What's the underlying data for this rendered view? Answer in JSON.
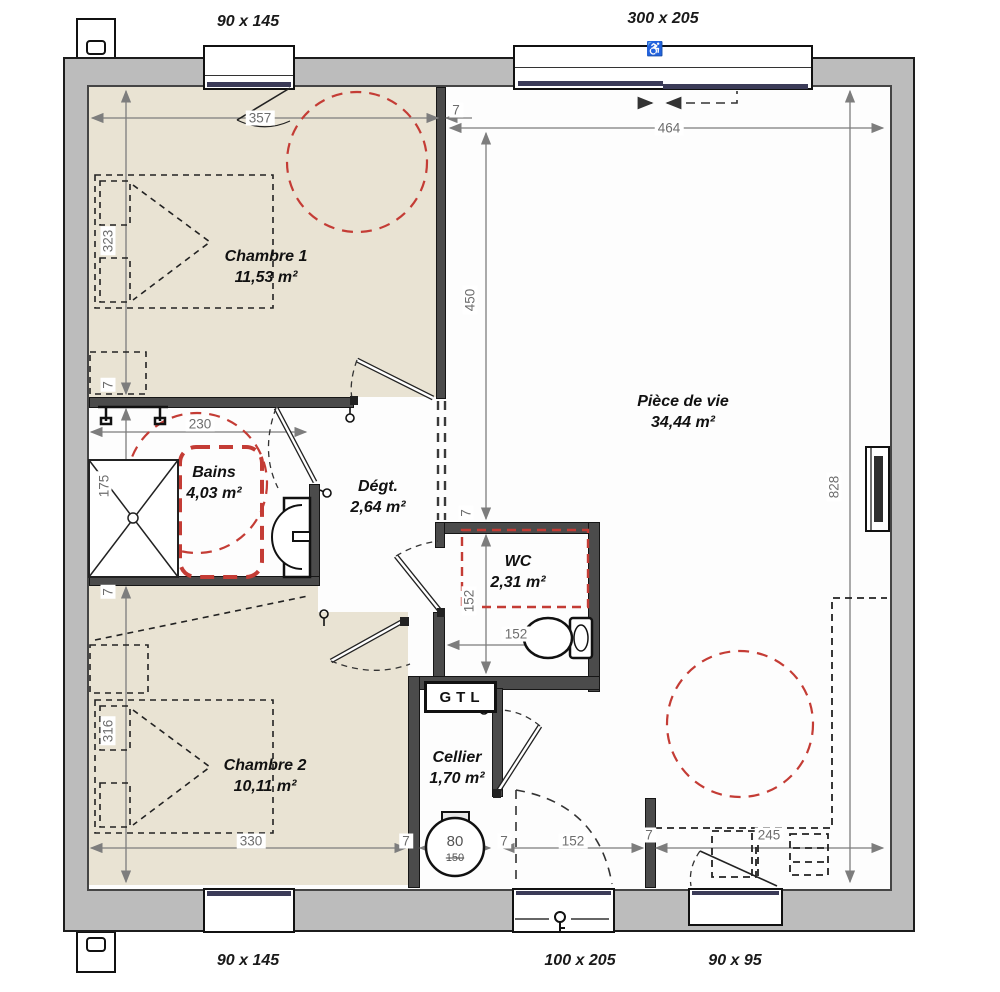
{
  "plan": {
    "openings": {
      "top_left_window": "90 x 145",
      "top_right_bay": "300 x 205",
      "bottom_left_window": "90 x 145",
      "entry_door": "100 x 205",
      "bottom_right_window": "90 x 95"
    },
    "rooms": {
      "chambre1": {
        "name": "Chambre 1",
        "area": "11,53 m²"
      },
      "piece_de_vie": {
        "name": "Pièce de vie",
        "area": "34,44 m²"
      },
      "bains": {
        "name": "Bains",
        "area": "4,03 m²"
      },
      "degt": {
        "name": "Dégt.",
        "area": "2,64 m²"
      },
      "wc": {
        "name": "WC",
        "area": "2,31 m²"
      },
      "cellier": {
        "name": "Cellier",
        "area": "1,70 m²"
      },
      "chambre2": {
        "name": "Chambre 2",
        "area": "10,11 m²"
      }
    },
    "dimensions": {
      "d357": "357",
      "d464": "464",
      "d450": "450",
      "d323": "323",
      "d230": "230",
      "d175": "175",
      "d316": "316",
      "d330": "330",
      "d152": "152",
      "d245": "245",
      "d828": "828",
      "d80": "80",
      "d150": "150",
      "d7": "7"
    },
    "technical": {
      "gtl": "GTL"
    },
    "icons": {
      "accessibility": "♿"
    },
    "colors": {
      "floor_beige": "#e9e3d3",
      "wall_gray": "#bcbcbc",
      "red_marker": "#c43c35",
      "glazing_navy": "#3b3b58",
      "dim_gray": "#6e6e6e"
    }
  }
}
